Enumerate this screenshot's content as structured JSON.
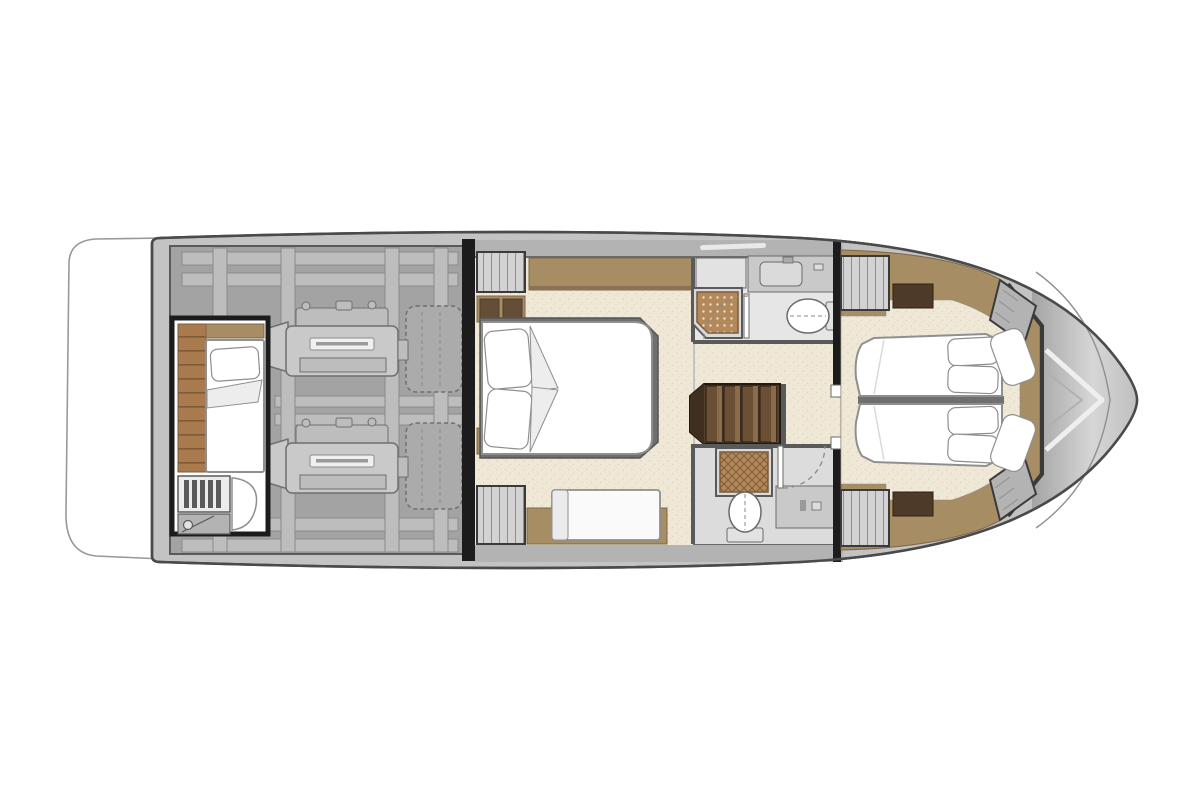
{
  "meta": {
    "description": "Motor yacht lower-deck floor plan, bow pointing right: swim platform, engine room with twin engines, aft crew cabin, midship master cabin, two bathrooms with teak shower grates, companionway stairs and forward twin-berth cabin",
    "canvas": {
      "width": 1200,
      "height": 800,
      "background": "#ffffff"
    }
  },
  "colors": {
    "canvas": "#ffffff",
    "hull_fill": "#c3c3c3",
    "hull_stroke": "#4a4a4a",
    "hull_inner_line": "#909090",
    "bow_dark": "#a4a4a4",
    "bow_light": "#d6d6d6",
    "chevron_white": "#efefef",
    "chevron_gray": "#b0b0b0",
    "wall": "#5a5a5a",
    "wall_dark": "#1c1c1c",
    "wall_dark2": "#3a3a3a",
    "deck_band": "#b3b3b3",
    "band_edge": "#6a6a6a",
    "engine_bg": "#a3a3a3",
    "engine_panel": "#bdbdbd",
    "engine_panel_stroke": "#8a8a8a",
    "engine_body": "#c9c9c9",
    "engine_stroke": "#6f6f6f",
    "engine_label_bg": "#f0f0f0",
    "engine_label_text": "#9a9a9a",
    "muffler": "#ababab",
    "cream": "#f0e8d6",
    "cream_speck": "#ddd2b9",
    "tan": "#a78d64",
    "tan_stroke": "#7c6747",
    "tan_edge": "#8a7354",
    "wood": "#a87a4e",
    "wood_line": "#7e5a36",
    "wicker": "#b3885a",
    "wicker_dot": "#efe0c8",
    "wicker_line": "#7d5c38",
    "darkwood": "#4e3a28",
    "darkwood_stroke": "#2f2315",
    "stair_dark": "#533f2e",
    "stair_mid": "#6b5036",
    "stair_light": "#8a6b4a",
    "stair_stroke": "#241a10",
    "white": "#ffffff",
    "mattress_stroke": "#8f8f8f",
    "fabric_fold": "#ededed",
    "cabinet_gray": "#d2d2d2",
    "hanger_line": "#8f8f8f",
    "fixture_stroke": "#6a6a6a",
    "fixture_fill": "#e2e2e2",
    "counter": "#c9c9c9",
    "basin": "#dadada",
    "bath_floor": "#e6e6e6",
    "bath_floor2": "#dcdcdc",
    "shower_pan": "#d9d9d9",
    "door_dash": "#8a8a8a",
    "ladder_bg": "#ececec",
    "platform_stroke": "#999999"
  },
  "plan": {
    "type": "yacht-lower-deck-floor-plan",
    "orientation": "bow-right",
    "areas": [
      {
        "id": "swim-platform",
        "label": "Swim platform",
        "features": [
          "white teak platform, rounded aft edge"
        ]
      },
      {
        "id": "engine-room",
        "label": "Engine room (aft)",
        "features": [
          "port engine",
          "starboard engine",
          "engine label plates",
          "dashed exhaust mufflers",
          "structural stringer grid"
        ]
      },
      {
        "id": "crew-cabin",
        "label": "Aft crew cabin",
        "features": [
          "single berth with pillow and folded blanket",
          "wood plank floor strip",
          "access ladder",
          "deck hatch with latch"
        ]
      },
      {
        "id": "master-cabin",
        "label": "Midship master cabin",
        "features": [
          "island double bed with two pillows",
          "hanging wardrobes fore and aft",
          "side shelf in wood",
          "lowboy cabinets",
          "settee bench",
          "wood trim band"
        ]
      },
      {
        "id": "bathroom-starboard",
        "label": "Starboard head (top)",
        "features": [
          "vanity counter with basin",
          "toilet",
          "teak shower grate (dotted)",
          "hinged door with swing arc"
        ]
      },
      {
        "id": "staircase",
        "label": "Companionway stairs",
        "features": [
          "four dark wood treads",
          "bevelled end"
        ]
      },
      {
        "id": "bathroom-port",
        "label": "Port head (bottom)",
        "features": [
          "teak shower grate (woven)",
          "toilet with base",
          "vanity counter",
          "hinged door with swing arc"
        ]
      },
      {
        "id": "corridor",
        "label": "Lower lobby",
        "features": [
          "speckled carpet floor",
          "two cabin doors with dashed swing arcs",
          "door posts"
        ]
      },
      {
        "id": "forward-cabin",
        "label": "Forward guest cabin",
        "features": [
          "two berths with centre divider",
          "four stacked pillows",
          "two angled bolster cushions at bow",
          "hanging wardrobes port and starboard",
          "dark wood dressers",
          "angled bow lockers",
          "wood floor border"
        ]
      },
      {
        "id": "bow-deck",
        "label": "Bow deck",
        "features": [
          "gradient grey deck",
          "double chevron deck lines"
        ]
      }
    ]
  }
}
